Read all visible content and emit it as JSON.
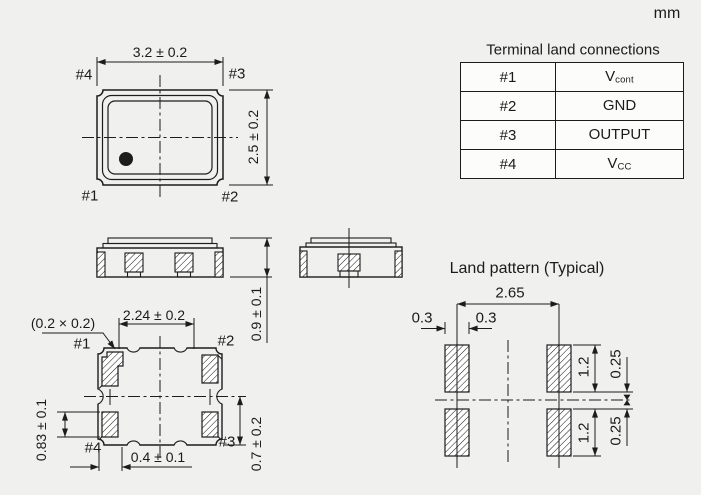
{
  "unit_label": "mm",
  "terminal_table": {
    "title": "Terminal land connections",
    "rows": [
      {
        "terminal": "#1",
        "connection": "V",
        "connection_sub": "cont"
      },
      {
        "terminal": "#2",
        "connection": "GND",
        "connection_sub": ""
      },
      {
        "terminal": "#3",
        "connection": "OUTPUT",
        "connection_sub": ""
      },
      {
        "terminal": "#4",
        "connection": "V",
        "connection_sub": "CC"
      }
    ]
  },
  "top_view": {
    "width_dim": "3.2 ± 0.2",
    "height_dim": "2.5 ± 0.2",
    "pin1_label": "#1",
    "pin2_label": "#2",
    "pin3_label": "#3",
    "pin4_label": "#4"
  },
  "side_view": {
    "height_dim": "0.9 ± 0.1"
  },
  "bottom_view": {
    "index_notch_dim": "(0.2 × 0.2)",
    "pad_pitch_dim": "2.24 ± 0.2",
    "pad_length_dim": "0.83 ± 0.1",
    "pad_width_dim": "0.4 ± 0.1",
    "center_offset_dim": "0.7 ± 0.2",
    "pin1_label": "#1",
    "pin2_label": "#2",
    "pin3_label": "#3",
    "pin4_label": "#4"
  },
  "land_pattern": {
    "title": "Land pattern (Typical)",
    "pitch_dim": "2.65",
    "offset_left_dim": "0.3",
    "offset_right_dim": "0.3",
    "pad_length_top_dim": "1.2",
    "gap_top_dim": "0.25",
    "pad_length_bottom_dim": "1.2",
    "gap_bottom_dim": "0.25"
  },
  "colors": {
    "background": "#f0f0ee",
    "line": "#1c1c1c",
    "pad_fill": "#ffffff",
    "table_cell": "#fcfcfb"
  }
}
